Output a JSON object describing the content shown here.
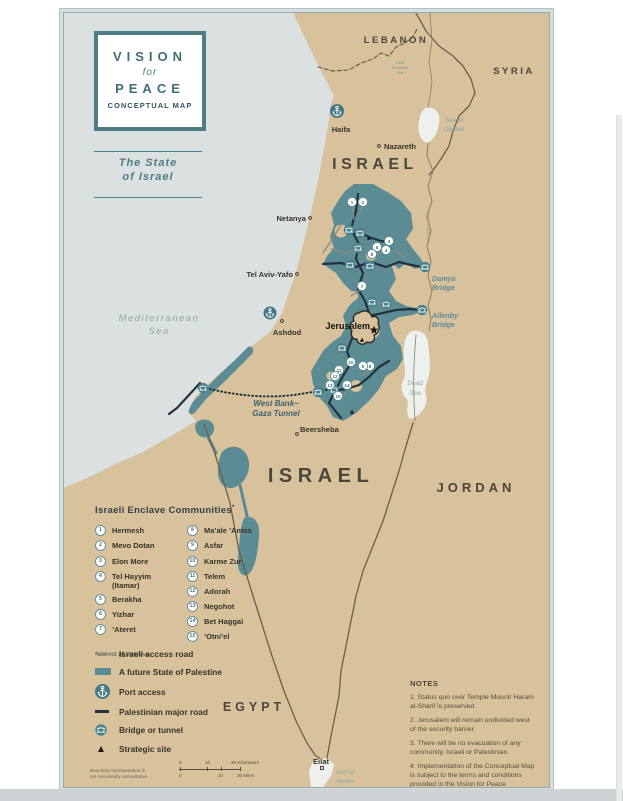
{
  "colors": {
    "accent_teal": "#4f7d85",
    "palestine_teal": "#5b8b93",
    "land_tan": "#d7c29b",
    "sea_gray": "#dbe1e1",
    "road_dark": "#233140",
    "road_access": "#8f8c7c"
  },
  "title_box": {
    "l1": "VISION",
    "l2": "for",
    "l3": "PEACE",
    "l4": "CONCEPTUAL MAP"
  },
  "subtitle": {
    "l1": "The State",
    "l2": "of Israel"
  },
  "countries": {
    "lebanon": "LEBANON",
    "syria": "SYRIA",
    "israel_north": "ISRAEL",
    "israel_south": "ISRAEL",
    "jordan": "JORDAN",
    "egypt": "EGYPT"
  },
  "cities": {
    "haifa": "Haifa",
    "nazareth": "Nazareth",
    "netanya": "Netanya",
    "tel_aviv": "Tel Aviv-Yafo",
    "ashdod": "Ashdod",
    "jerusalem": "Jerusalem",
    "beersheba": "Beersheba",
    "eilat": "Eilat"
  },
  "water": {
    "med_1": "Mediterranean",
    "med_2": "Sea",
    "galilee_1": "Sea of",
    "galilee_2": "Galilee",
    "dead_1": "Dead",
    "dead_2": "Sea",
    "gulf_1": "Gulf of",
    "gulf_2": "Aqaba",
    "jordan_river": "Jordan River"
  },
  "bridges": {
    "damya_1": "Damya",
    "damya_2": "Bridge",
    "allenby_1": "Allenby",
    "allenby_2": "Bridge"
  },
  "tunnel": {
    "l1": "West Bank–",
    "l2": "Gaza Tunnel"
  },
  "armistice": {
    "l1": "1949",
    "l2": "Armistice",
    "l3": "Line"
  },
  "enclave_legend": {
    "title": "Israeli Enclave Communities",
    "asterisk": "*",
    "footnote": "*List not all inclusive.",
    "items": [
      {
        "n": "1",
        "name": "Hermesh"
      },
      {
        "n": "2",
        "name": "Mevo Dotan"
      },
      {
        "n": "3",
        "name": "Elon More"
      },
      {
        "n": "4",
        "name": "Tel Hayyim (Itamar)"
      },
      {
        "n": "5",
        "name": "Berakha"
      },
      {
        "n": "6",
        "name": "Yizhar"
      },
      {
        "n": "7",
        "name": "’Ateret"
      },
      {
        "n": "8",
        "name": "Ma’ale ’Amos"
      },
      {
        "n": "9",
        "name": "Asfar"
      },
      {
        "n": "10",
        "name": "Karme Zur"
      },
      {
        "n": "11",
        "name": "Telem"
      },
      {
        "n": "12",
        "name": "Adorah"
      },
      {
        "n": "13",
        "name": "Negohot"
      },
      {
        "n": "14",
        "name": "Bet Haggai"
      },
      {
        "n": "15",
        "name": "’Otni’el"
      }
    ]
  },
  "map_legend": {
    "items": [
      "Israeli access road",
      "A future State of Palestine",
      "Port access",
      "Palestinian major road",
      "Bridge or tunnel",
      "Strategic site"
    ]
  },
  "scale": {
    "k0": "0",
    "k1": "10",
    "k2": "20 Kilometers",
    "m0": "0",
    "m1": "10",
    "m2": "20 Miles"
  },
  "attribution": {
    "l1": "Boundary representation is",
    "l2": "not necessarily authoritative."
  },
  "notes": {
    "title": "NOTES",
    "n1": "1. Status quo over Temple Mount/ Haram al-Sharif is preserved.",
    "n2": "2. Jerusalem will remain undivided west of the security barrier.",
    "n3": "3. There will be no evacuation of any community, Israeli or Palestinian.",
    "n4": "4. Implementation of the Conceptual Map is subject to the terms and conditions provided in the Vision for Peace."
  }
}
